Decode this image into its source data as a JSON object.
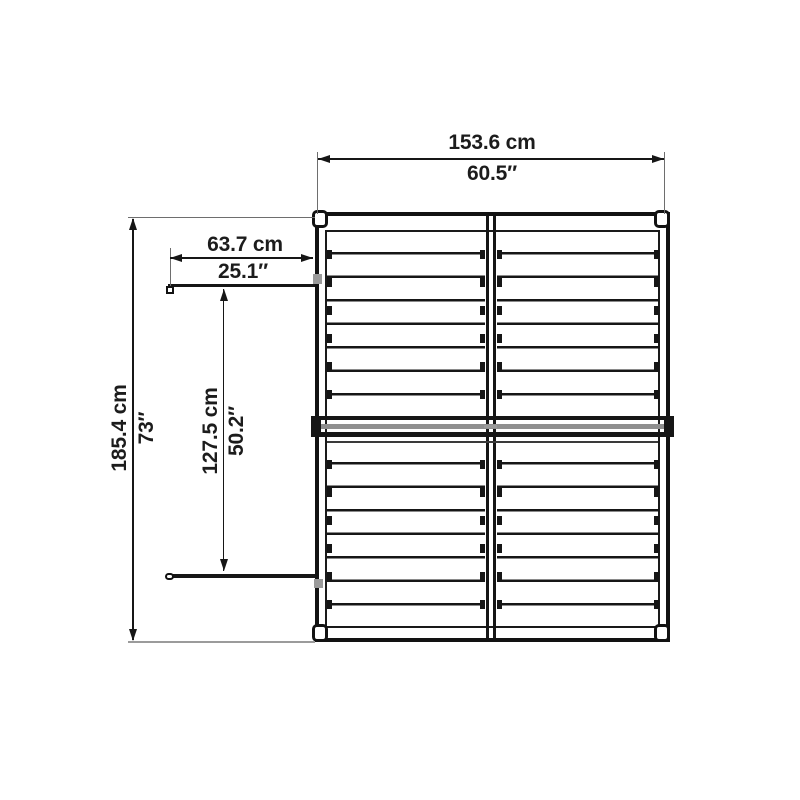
{
  "diagram": {
    "subject": "shed-top-view-dimension-drawing",
    "colors": {
      "line": "#161616",
      "extension_line": "#6e6e6e",
      "light_extension_line": "#9b9b9b",
      "beam_gray": "#8f8f8f",
      "text": "#1c1c1c",
      "background": "#ffffff"
    },
    "dimensions": {
      "overall_width": {
        "metric": "153.6 cm",
        "imperial": "60.5″"
      },
      "door_width": {
        "metric": "63.7 cm",
        "imperial": "25.1″"
      },
      "overall_depth": {
        "metric": "185.4 cm",
        "imperial": "73″"
      },
      "doors_span": {
        "metric": "127.5 cm",
        "imperial": "50.2″"
      }
    }
  }
}
